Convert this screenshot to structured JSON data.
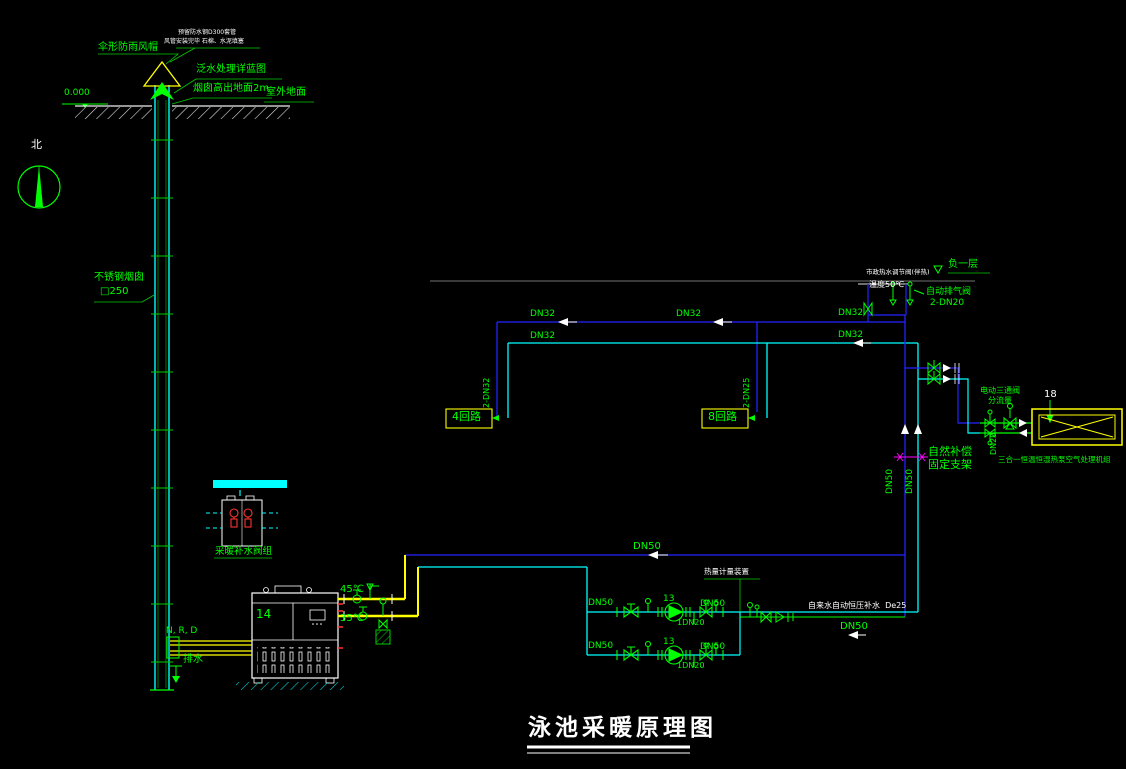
{
  "drawing": {
    "title": "泳池采暖原理图",
    "colors": {
      "background": "#000000",
      "pipe_green": "#00ff00",
      "pipe_cyan": "#00ffff",
      "pipe_blue": "#2323ff",
      "pipe_yellow": "#ffff00",
      "annotation_white": "#ffffff",
      "support_magenta": "#ff00ff",
      "alarm_red": "#ff3333"
    },
    "labels": {
      "rain_cap": "伞形防雨风帽",
      "sleeve_note": "预留防水钢D300套管",
      "fill_note": "风管安装完毕 石棉、水泥填塞",
      "flashing_note": "泛水处理详蓝图",
      "stack_height_note": "烟囱高出地面2m",
      "level_zero": "0.000",
      "outdoor_ground": "室外地面",
      "north": "北",
      "stack_material": "不锈钢烟囱",
      "stack_size": "□250",
      "nrd": "N, R, D",
      "drain": "排水",
      "boiler_no": "14",
      "t_supply": "45℃",
      "t_return": "35℃",
      "makeup_valve_group": "采暖补水阀组",
      "dn50": "DN50",
      "dn32": "DN32",
      "dn20": "DN20",
      "loop4": "4回路",
      "loop4_size": "2-DN32",
      "loop8": "8回路",
      "loop8_size": "2-DN25",
      "municipal_note": "市政热水调节阀(伴热)",
      "temp50": "温度50℃",
      "basement": "负一层",
      "auto_vent": "自动排气阀",
      "auto_vent_size": "2-DN20",
      "natural_comp": "自然补偿",
      "fixed_support": "固定支架",
      "three_way_valve": "电动三通阀",
      "diverting": "分流量",
      "hx_no": "18",
      "hx_caption": "三合一恒温恒湿热泵空气处理机组",
      "meter_note": "热量计量装置",
      "tap_water_note": "自来水自动恒压补水  De25",
      "pump_no": "13",
      "pump_drain": "1DN20"
    }
  }
}
